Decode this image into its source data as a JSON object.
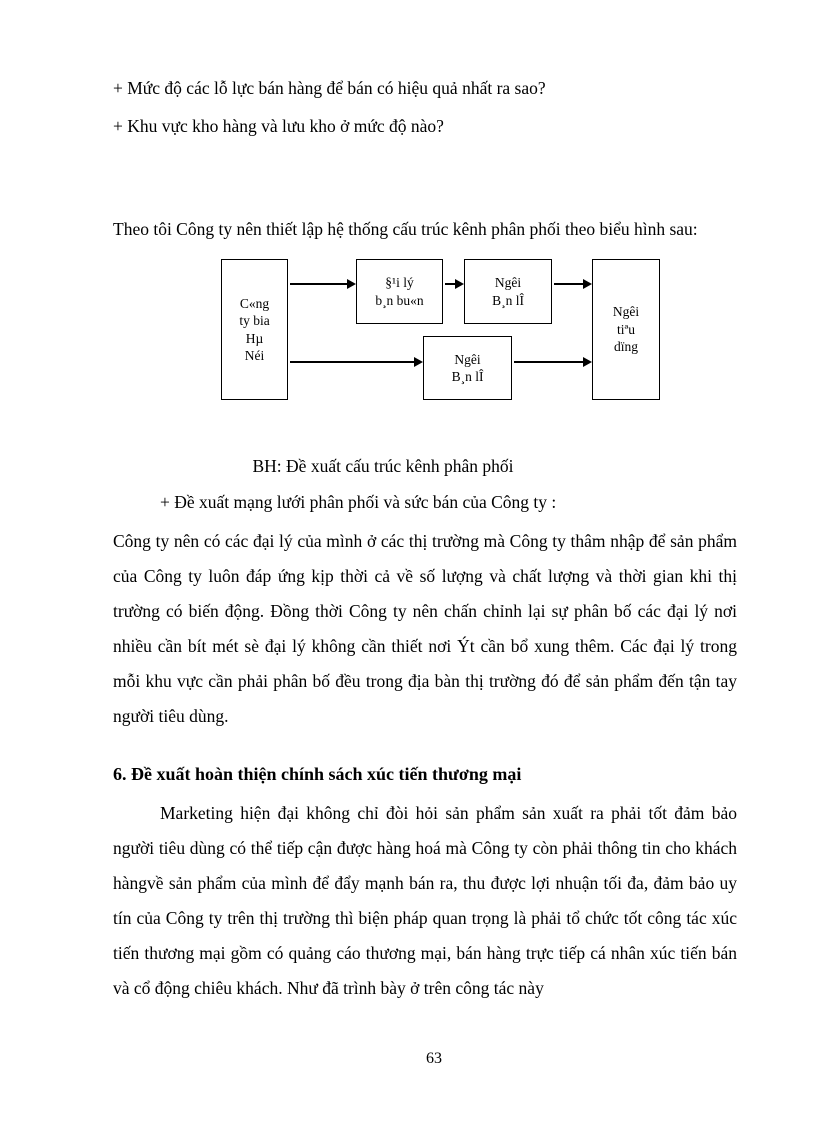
{
  "document": {
    "questions": [
      "+ Mức độ các lỗ lực bán hàng để bán có hiệu quả nhất ra sao?",
      "+ Khu vực kho hàng và lưu kho ở mức độ nào?"
    ],
    "intro_line": "Theo tôi Công ty nên thiết lập hệ thống cấu trúc kênh phân phối theo biểu hình sau:",
    "diagram": {
      "boxes": {
        "company": "C«ng\nty bia\nHµ\nNéi",
        "wholesaler": "§¹i lý\nb¸n bu«n",
        "retailer_top": "Ngêi\nB¸n lÎ",
        "retailer_bottom": "Ngêi\nB¸n lÎ",
        "consumer": "Ngêi\ntiªu\ndïng"
      }
    },
    "caption": "BH: Đề xuất cấu trúc kênh phân phối",
    "proposal_line": "+ Đề xuất mạng lưới phân phối và sức bán của Công ty :",
    "paragraph_distribution": "Công ty nên có các đại lý của mình ở các thị trường mà Công ty thâm nhập để sản phẩm của Công ty luôn đáp ứng kịp thời cả về số lượng và chất lượng và thời gian khi thị trường có biến động. Đồng thời Công ty nên chấn chỉnh lại sự phân bố các đại lý nơi nhiều cần bít mét sè đại lý không cần thiết nơi Ýt cần bổ xung thêm. Các đại lý trong mỗi khu vực cần phải phân bố đều trong địa bàn thị trường đó để sản phẩm đến tận tay người tiêu dùng.",
    "section_heading": "6. Đề xuất hoàn thiện chính sách xúc tiến thương mại",
    "paragraph_promotion": "Marketing hiện đại không chỉ đòi hỏi sản phẩm sản xuất ra phải tốt đảm bảo người tiêu dùng có thể tiếp cận được hàng hoá mà Công ty còn phải thông tin cho khách hàngvề sản phẩm của mình để đẩy mạnh bán ra, thu được lợi nhuận tối đa, đảm bảo uy tín của Công ty trên thị trường thì biện pháp quan trọng là phải tổ chức tốt công tác xúc tiến thương mại gồm có quảng cáo thương mại, bán hàng trực tiếp cá nhân xúc tiến bán và cổ động chiêu khách. Như đã trình bày ở trên công tác này",
    "page_number": "63"
  }
}
